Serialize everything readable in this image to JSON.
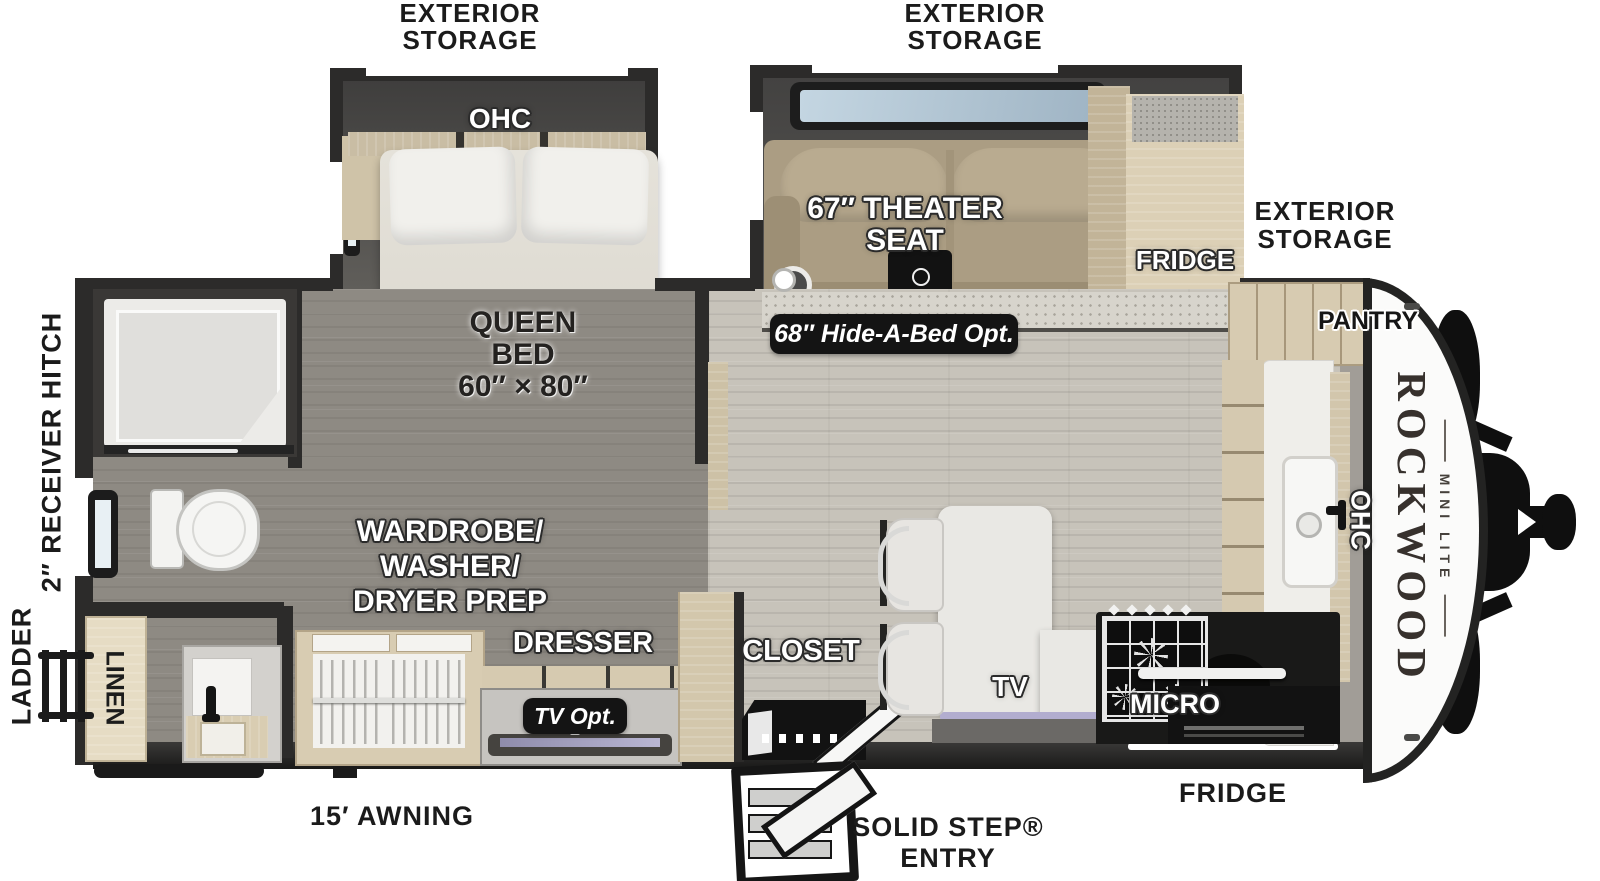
{
  "title": "Rockwood Mini Lite travel trailer floorplan",
  "palette": {
    "wall": "#2c2b2a",
    "floor_bedroom": "#8e8a83",
    "floor_living": "#c7c3ba",
    "wood_cabinet": "#d8ccb2",
    "counter_white": "#efeeea",
    "appliance_black": "#161616",
    "theater_seat_tan": "#ab9d83",
    "window_glass": "#b7cbd9",
    "tv_accent": "#b2adcf",
    "label_white": "#ffffff",
    "label_black": "#1b1b1b"
  },
  "brand": {
    "name": "ROCKWOOD",
    "model": "MINI LITE"
  },
  "labels": {
    "exterior_storage": {
      "l1": "EXTERIOR",
      "l2": "STORAGE"
    },
    "receiver_hitch": "2″ RECEIVER HITCH",
    "ladder": "LADDER",
    "awning": "15′ AWNING",
    "solid_step": {
      "l1": "SOLID STEP®",
      "l2": "ENTRY"
    },
    "fridge": "FRIDGE",
    "pantry": "PANTRY",
    "ohc": "OHC",
    "queen_bed": {
      "l1": "QUEEN",
      "l2": "BED",
      "l3": "60″ × 80″"
    },
    "theater_seat": {
      "l1": "67″ THEATER",
      "l2": "SEAT"
    },
    "hide_a_bed": "68″ Hide-A-Bed Opt.",
    "wardrobe": {
      "l1": "WARDROBE/",
      "l2": "WASHER/",
      "l3": "DRYER PREP"
    },
    "dresser": "DRESSER",
    "tv_opt": "TV Opt.",
    "closet": "CLOSET",
    "tv": "TV",
    "micro": "MICRO",
    "linen": "LINEN"
  }
}
